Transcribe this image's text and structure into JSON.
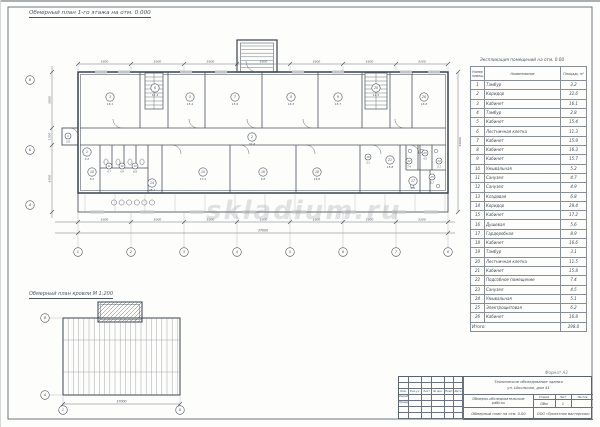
{
  "sheet": {
    "main_plan_title": "Обмерный план 1-го этажа на отм. 0.000",
    "secondary_plan_title": "Обмерный план кровли М 1:200",
    "watermark": "skladium.ru",
    "format_note": "Формат А3"
  },
  "main_plan": {
    "axes_bottom": [
      "1",
      "2",
      "3",
      "4",
      "5",
      "6",
      "7",
      "8"
    ],
    "axes_left": [
      "В",
      "Б",
      "А"
    ],
    "dims_bottom": [
      "5300",
      "5300",
      "5300",
      "5300",
      "5300",
      "5300",
      "5200"
    ],
    "dim_total_bottom": "37000",
    "dims_left": [
      "5600",
      "1700",
      "6700"
    ],
    "dim_total_left": "14000",
    "rooms": [
      {
        "num": "1",
        "area": "3.2"
      },
      {
        "num": "2",
        "area": "32.6"
      },
      {
        "num": "3",
        "area": "16.1"
      },
      {
        "num": "4",
        "area": "2.8"
      },
      {
        "num": "5",
        "area": "15.4"
      },
      {
        "num": "6",
        "area": "11.3"
      },
      {
        "num": "7",
        "area": "15.9"
      },
      {
        "num": "8",
        "area": "16.3"
      },
      {
        "num": "9",
        "area": "15.7"
      },
      {
        "num": "10",
        "area": "5.2"
      },
      {
        "num": "11",
        "area": "4.7"
      },
      {
        "num": "12",
        "area": "4.9"
      },
      {
        "num": "13",
        "area": "6.8"
      },
      {
        "num": "14",
        "area": "28.4"
      },
      {
        "num": "15",
        "area": "17.2"
      },
      {
        "num": "16",
        "area": "5.6"
      },
      {
        "num": "17",
        "area": "8.9"
      },
      {
        "num": "18",
        "area": "16.6"
      },
      {
        "num": "19",
        "area": "3.1"
      },
      {
        "num": "20",
        "area": "11.5"
      },
      {
        "num": "21",
        "area": "15.8"
      },
      {
        "num": "22",
        "area": "7.4"
      },
      {
        "num": "23",
        "area": "4.5"
      },
      {
        "num": "24",
        "area": "5.1"
      },
      {
        "num": "25",
        "area": "6.2"
      },
      {
        "num": "26",
        "area": "16.8"
      }
    ]
  },
  "roof_plan": {
    "axes_left": [
      "В",
      "А"
    ],
    "axes_bottom": [
      "1",
      "8"
    ],
    "dim_total": "37000"
  },
  "schedule": {
    "title": "Экспликация помещений на отм. 0.00",
    "columns": [
      "Номер помещ.",
      "Наименование",
      "Площадь, м²"
    ],
    "rows": [
      [
        "1",
        "Тамбур",
        "3.2"
      ],
      [
        "2",
        "Коридор",
        "32.6"
      ],
      [
        "3",
        "Кабинет",
        "16.1"
      ],
      [
        "4",
        "Тамбур",
        "2.8"
      ],
      [
        "5",
        "Кабинет",
        "15.4"
      ],
      [
        "6",
        "Лестничная клетка",
        "11.3"
      ],
      [
        "7",
        "Кабинет",
        "15.9"
      ],
      [
        "8",
        "Кабинет",
        "16.3"
      ],
      [
        "9",
        "Кабинет",
        "15.7"
      ],
      [
        "10",
        "Умывальная",
        "5.2"
      ],
      [
        "11",
        "Санузел",
        "4.7"
      ],
      [
        "12",
        "Санузел",
        "4.9"
      ],
      [
        "13",
        "Кладовая",
        "6.8"
      ],
      [
        "14",
        "Коридор",
        "28.4"
      ],
      [
        "15",
        "Кабинет",
        "17.2"
      ],
      [
        "16",
        "Душевая",
        "5.6"
      ],
      [
        "17",
        "Гардеробная",
        "8.9"
      ],
      [
        "18",
        "Кабинет",
        "16.6"
      ],
      [
        "19",
        "Тамбур",
        "3.1"
      ],
      [
        "20",
        "Лестничная клетка",
        "11.5"
      ],
      [
        "21",
        "Кабинет",
        "15.8"
      ],
      [
        "22",
        "Подсобное помещение",
        "7.4"
      ],
      [
        "23",
        "Санузел",
        "4.5"
      ],
      [
        "24",
        "Умывальная",
        "5.1"
      ],
      [
        "25",
        "Электрощитовая",
        "6.2"
      ],
      [
        "26",
        "Кабинет",
        "16.8"
      ]
    ],
    "total_label": "Итого:",
    "total_value": "298.0"
  },
  "title_block": {
    "header_cells": [
      "Изм.",
      "Кол.уч.",
      "Лист",
      "№ док.",
      "Подп.",
      "Дата"
    ],
    "row_labels": [
      "Разраб.",
      "Проверил"
    ],
    "project_line1": "Техническое обследование здания",
    "project_line2": "ул. Школьная, дом 41",
    "doc_type": "Обмерно-обследовательские работы",
    "sheet_name": "Обмерный план на отм. 0.00",
    "org_name": "ООО «Проектная мастерская»",
    "stage_header": [
      "Стадия",
      "Лист",
      "Листов"
    ],
    "stage_value": "Обм",
    "sheet_number": "1",
    "sheets_total": ""
  }
}
